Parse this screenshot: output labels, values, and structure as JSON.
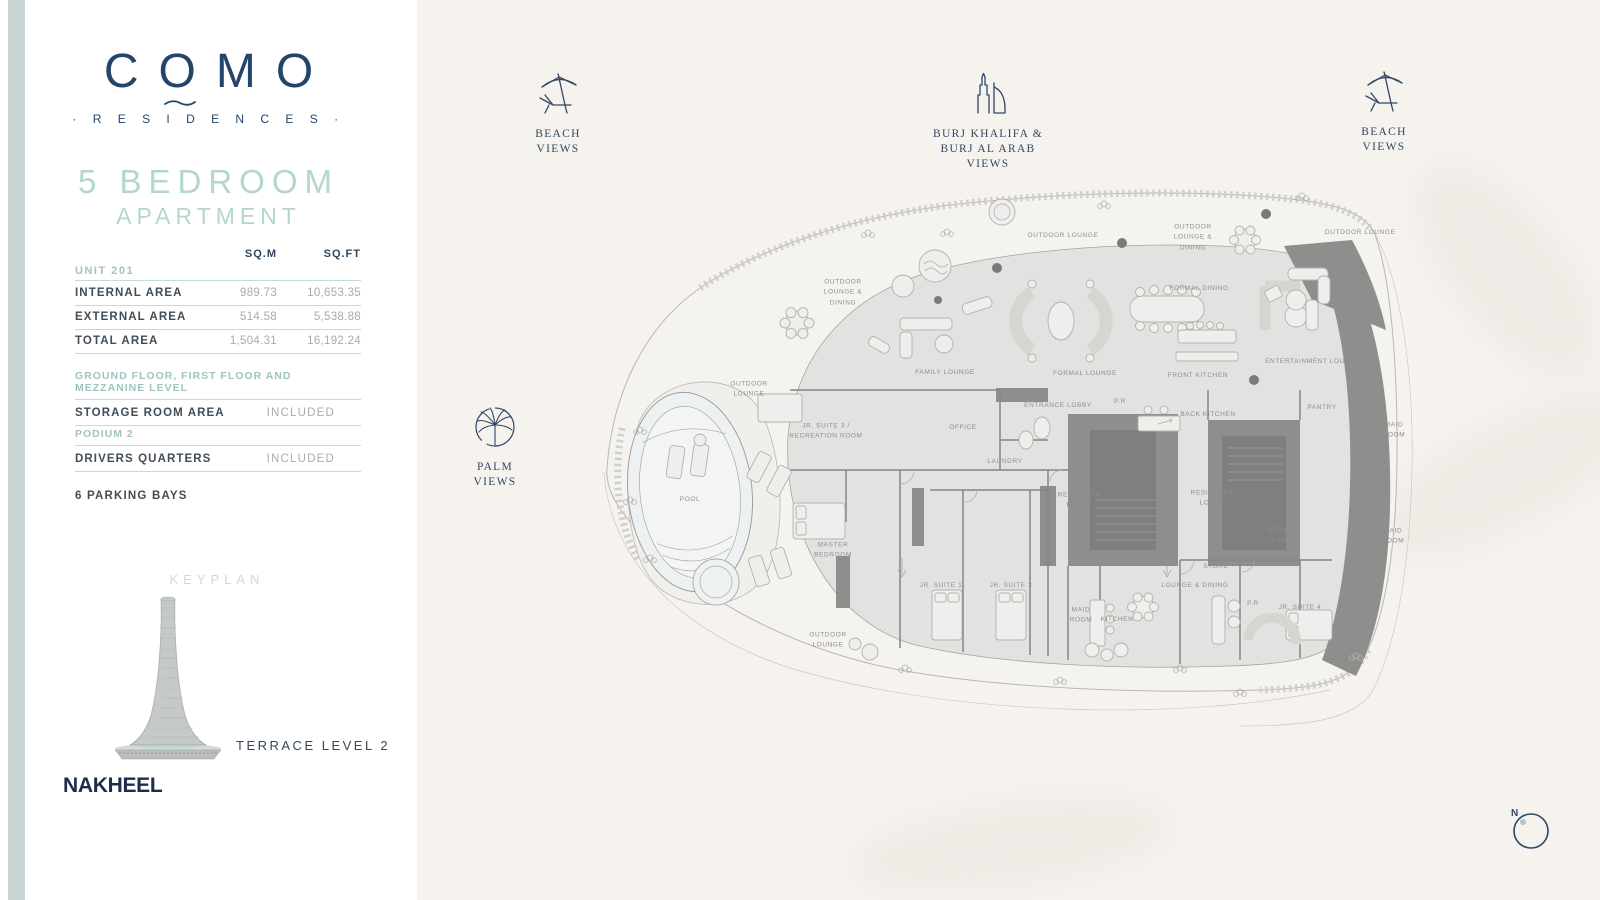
{
  "sidebar": {
    "logo": {
      "text": "COMO",
      "sub": "· R E S I D E N C E S ·"
    },
    "title": {
      "line1": "5 BEDROOM",
      "line2": "APARTMENT"
    },
    "area_table": {
      "headers": {
        "sqm": "SQ.M",
        "sqft": "SQ.FT"
      },
      "section": "UNIT 201",
      "rows": [
        {
          "label": "INTERNAL AREA",
          "sqm": "989.73",
          "sqft": "10,653.35"
        },
        {
          "label": "EXTERNAL AREA",
          "sqm": "514.58",
          "sqft": "5,538.88"
        },
        {
          "label": "TOTAL AREA",
          "sqm": "1,504.31",
          "sqft": "16,192.24"
        }
      ]
    },
    "floor_section": {
      "header": "GROUND FLOOR, FIRST FLOOR AND MEZZANINE LEVEL",
      "label": "STORAGE ROOM AREA",
      "value": "INCLUDED"
    },
    "podium_section": {
      "header": "PODIUM 2",
      "label": "DRIVERS QUARTERS",
      "value": "INCLUDED"
    },
    "parking_note": "6 PARKING BAYS",
    "keyplan": {
      "title": "KEYPLAN",
      "level": "TERRACE LEVEL 2"
    },
    "developer": "NAKHEEL"
  },
  "views": {
    "beach_left": {
      "label": "BEACH\nVIEWS"
    },
    "burj": {
      "label": "BURJ KHALIFA &\nBURJ AL ARAB VIEWS"
    },
    "beach_right": {
      "label": "BEACH\nVIEWS"
    },
    "palm": {
      "label": "PALM\nVIEWS"
    }
  },
  "compass": {
    "label": "N"
  },
  "floor_plan": {
    "pool_label": "POOL",
    "rooms": [
      {
        "label": "OUTDOOR LOUNGE",
        "x": 1063,
        "y": 236
      },
      {
        "label": "OUTDOOR\nLOUNGE &\nDINING",
        "x": 1193,
        "y": 238
      },
      {
        "label": "OUTDOOR LOUNGE",
        "x": 1360,
        "y": 233
      },
      {
        "label": "OUTDOOR\nLOUNGE &\nDINING",
        "x": 843,
        "y": 293
      },
      {
        "label": "FORMAL DINING",
        "x": 1199,
        "y": 289
      },
      {
        "label": "FAMILY LOUNGE",
        "x": 945,
        "y": 373
      },
      {
        "label": "FORMAL LOUNGE",
        "x": 1085,
        "y": 374
      },
      {
        "label": "FRONT KITCHEN",
        "x": 1198,
        "y": 376
      },
      {
        "label": "ENTERTAINMENT LOUNGE",
        "x": 1313,
        "y": 362
      },
      {
        "label": "OUTDOOR\nLOUNGE",
        "x": 749,
        "y": 390
      },
      {
        "label": "ENTRANCE LOBBY",
        "x": 1058,
        "y": 406
      },
      {
        "label": "P.R",
        "x": 1120,
        "y": 402
      },
      {
        "label": "BACK KITCHEN",
        "x": 1208,
        "y": 415
      },
      {
        "label": "PANTRY",
        "x": 1322,
        "y": 408
      },
      {
        "label": "MAID\nROOM",
        "x": 1394,
        "y": 431
      },
      {
        "label": "JR. SUITE 3 /\nRECREATION ROOM",
        "x": 826,
        "y": 432
      },
      {
        "label": "OFFICE",
        "x": 963,
        "y": 428
      },
      {
        "label": "LAUNDRY",
        "x": 1005,
        "y": 462
      },
      {
        "label": "RESIDENTS\nENTRY",
        "x": 1079,
        "y": 501
      },
      {
        "label": "RESIDENTS\nLOBBY",
        "x": 1212,
        "y": 499
      },
      {
        "label": "POOL",
        "x": 690,
        "y": 500
      },
      {
        "label": "MASTER\nBEDROOM",
        "x": 833,
        "y": 551
      },
      {
        "label": "SERVICE\nLOBBY",
        "x": 1284,
        "y": 536
      },
      {
        "label": "MAID\nROOM",
        "x": 1393,
        "y": 537
      },
      {
        "label": "STORE",
        "x": 1216,
        "y": 567
      },
      {
        "label": "JR. SUITE 1",
        "x": 941,
        "y": 586
      },
      {
        "label": "JR. SUITE 2",
        "x": 1011,
        "y": 586
      },
      {
        "label": "LOUNGE & DINING",
        "x": 1195,
        "y": 586
      },
      {
        "label": "MAID\nROOM",
        "x": 1081,
        "y": 616
      },
      {
        "label": "KITCHEN",
        "x": 1117,
        "y": 620
      },
      {
        "label": "P.R",
        "x": 1253,
        "y": 604
      },
      {
        "label": "JR. SUITE 4",
        "x": 1300,
        "y": 608
      },
      {
        "label": "OUTDOOR\nLOUNGE",
        "x": 828,
        "y": 641
      }
    ]
  },
  "colors": {
    "navy": "#24456b",
    "teal": "#9fc4c1",
    "teal_light": "#b5d5d0",
    "band": "#c7d5d4",
    "bg": "#f6f3ef"
  }
}
